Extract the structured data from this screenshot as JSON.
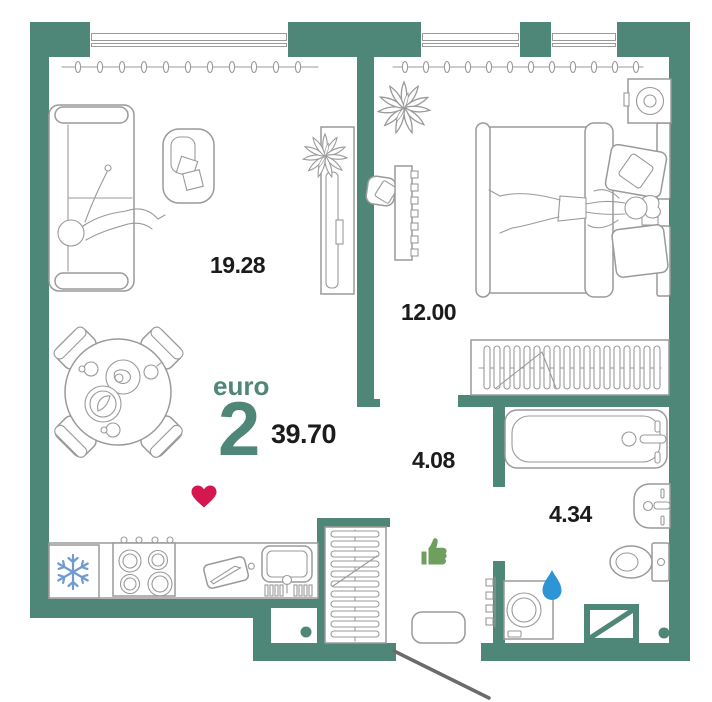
{
  "plan": {
    "unit_type_label": "euro",
    "unit_rooms_count": "2",
    "unit_total_area": "39.70",
    "rooms": [
      {
        "id": "living-kitchen",
        "area": "19.28"
      },
      {
        "id": "bedroom",
        "area": "12.00"
      },
      {
        "id": "hallway",
        "area": "4.08"
      },
      {
        "id": "bathroom",
        "area": "4.34"
      }
    ],
    "icons": [
      "snowflake-icon",
      "heart-icon",
      "thumbs-up-icon",
      "water-drop-icon"
    ],
    "colors": {
      "wall": "#4E8677",
      "heart": "#D6164F",
      "thumb": "#6F9F5E",
      "drop": "#2D95D5",
      "snowflake": "#6F9AD0",
      "outline": "#9A9A9A",
      "label": "#1B1B1B"
    }
  }
}
